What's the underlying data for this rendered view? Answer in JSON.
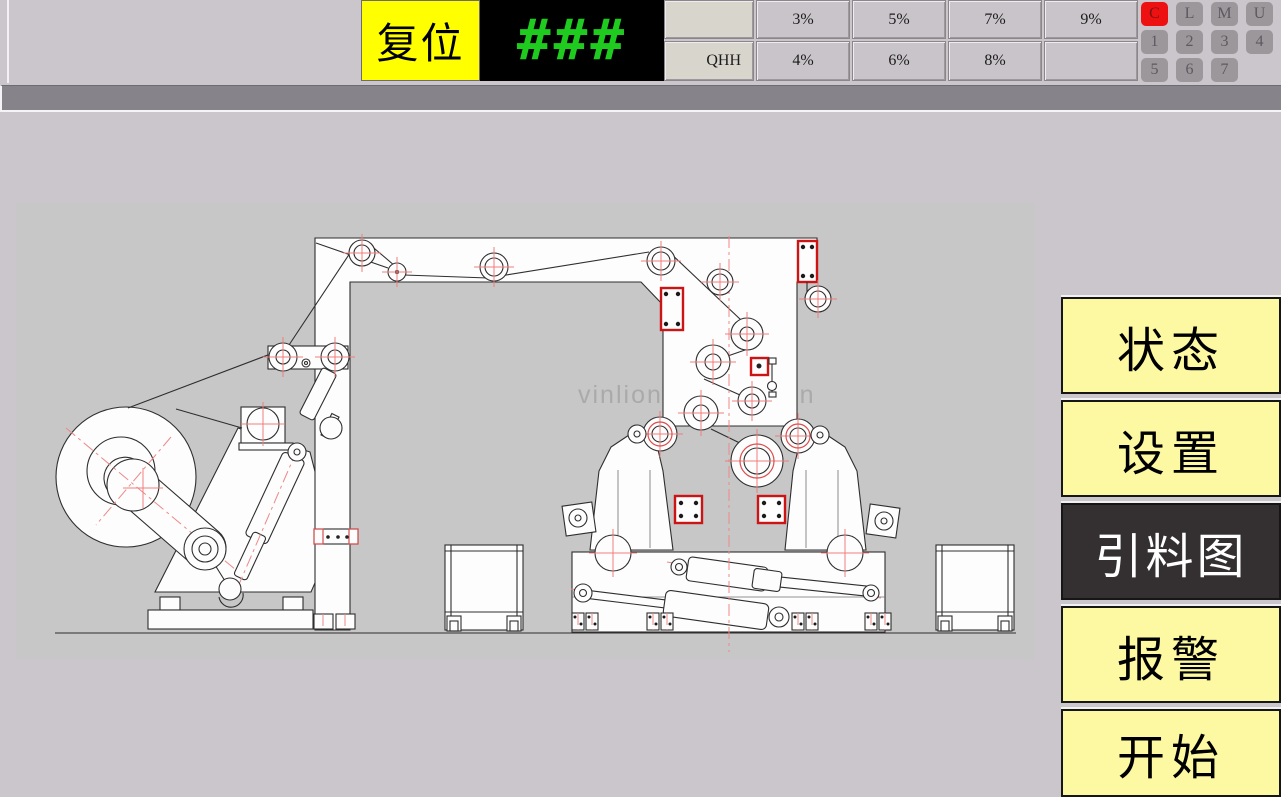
{
  "top_bar": {
    "reset_label": "复位",
    "display_value": "###",
    "percent_grid": {
      "row1": [
        "",
        "3%",
        "5%",
        "7%",
        "9%"
      ],
      "row2": [
        "QHH",
        "4%",
        "6%",
        "8%",
        ""
      ]
    },
    "keypad": [
      "C",
      "L",
      "M",
      "U",
      "1",
      "2",
      "3",
      "4",
      "5",
      "6",
      "7"
    ]
  },
  "menu": {
    "items": [
      {
        "label": "状态",
        "active": false
      },
      {
        "label": "设置",
        "active": false
      },
      {
        "label": "引料图",
        "active": true
      },
      {
        "label": "报警",
        "active": false
      },
      {
        "label": "开始",
        "active": false
      }
    ]
  },
  "canvas": {
    "watermark": "vinlion automation"
  },
  "colors": {
    "reset_bg": "#ffff00",
    "led_green": "#1fcb1f",
    "menu_yellow": "#fdf9a2",
    "menu_active_bg": "#343031",
    "alarm_red": "#ee1111",
    "accent_red": "#cc1414",
    "canvas_bg": "#c7c7c7",
    "page_bg": "#cbc6cb"
  }
}
